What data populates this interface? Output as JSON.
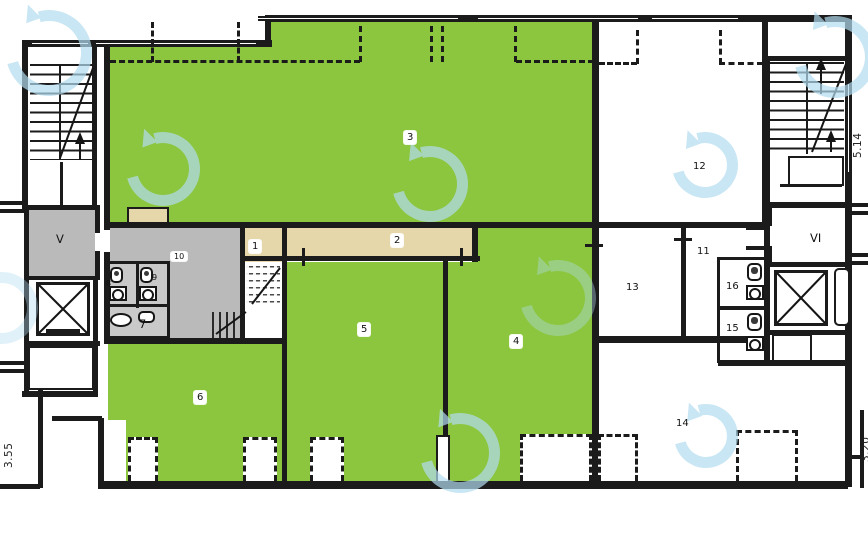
{
  "floorplan": {
    "room_labels": {
      "r1": "1",
      "r2": "2",
      "r3": "3",
      "r4": "4",
      "r5": "5",
      "r6": "6",
      "r7": "7",
      "r8": "8",
      "r9": "9",
      "r10": "10",
      "r11": "11",
      "r12": "12",
      "r13": "13",
      "r14": "14",
      "r15": "15",
      "r16": "16",
      "elevator_lobby_left": "V",
      "elevator_lobby_right": "VI"
    },
    "dimension_labels": {
      "left_edge": "3.55",
      "right_edge_upper": "5.14",
      "right_edge_lower": "3.20"
    },
    "colors": {
      "highlight_green": "#8cc63e",
      "corridor_tan": "#e6d7ab",
      "core_gray": "#bababa",
      "toilet_gray": "#c9c9c9",
      "wall_black": "#1b1b1b",
      "watermark_blue": "#b3dcf0"
    }
  }
}
